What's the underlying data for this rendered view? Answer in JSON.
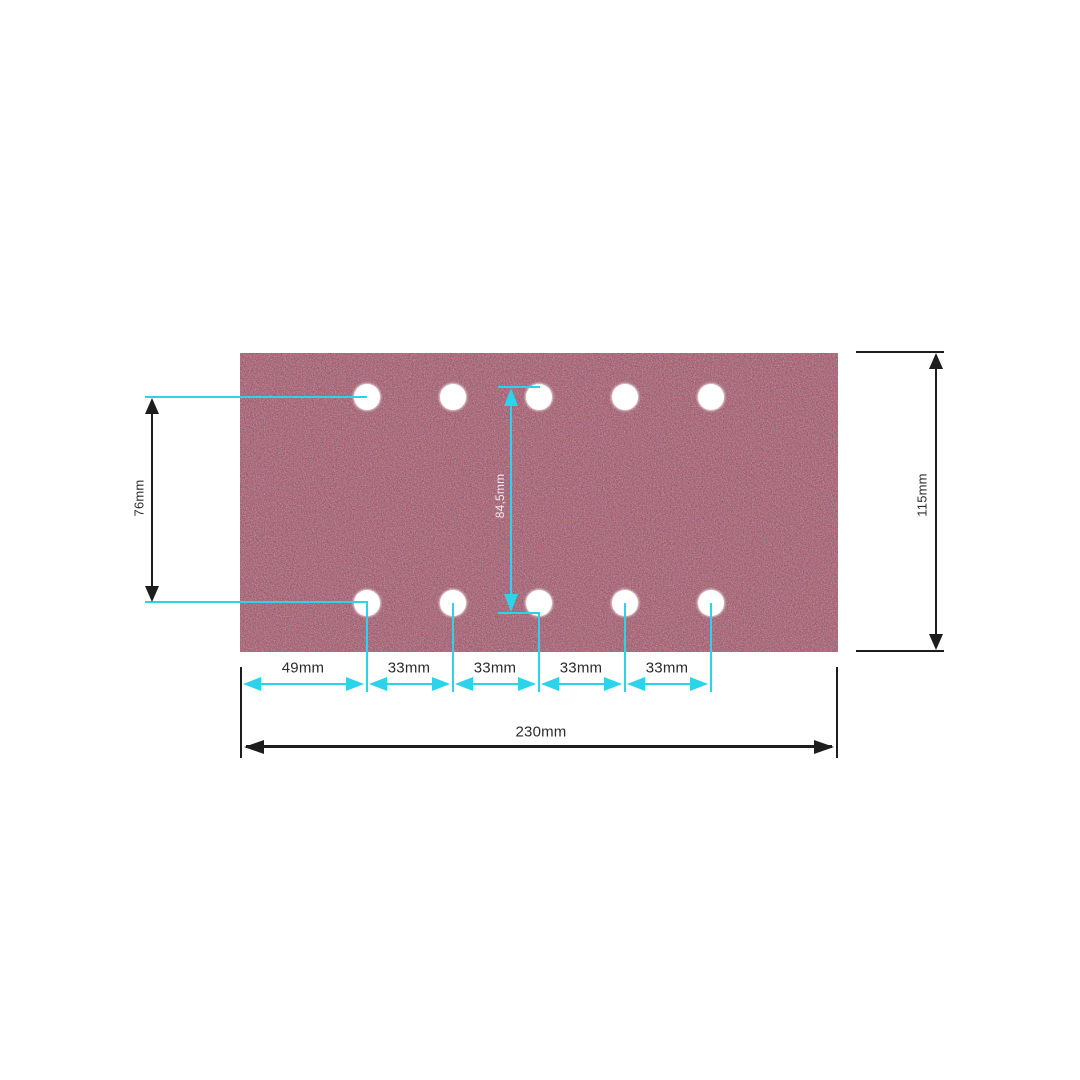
{
  "page": {
    "background_color": "#ffffff"
  },
  "diagram": {
    "type": "product-dimension-diagram",
    "subject": "rectangular sanding sheet with two rows of five punched holes",
    "colors": {
      "page_background": "#ffffff",
      "accent": "#2dd2eb",
      "line": "#1d1d1d",
      "sheet_base": "#571a29",
      "hole": "#ffffff",
      "label_text": "#2b2b2b",
      "label_text_light": "#efeaec"
    },
    "dimensions": {
      "left_vertical": {
        "label": "76mm"
      },
      "center_vertical": {
        "label": "84,5mm"
      },
      "right_vertical": {
        "label": "115mm"
      },
      "bottom_segments": [
        {
          "label": "49mm"
        },
        {
          "label": "33mm"
        },
        {
          "label": "33mm"
        },
        {
          "label": "33mm"
        },
        {
          "label": "33mm"
        }
      ],
      "bottom_total": {
        "label": "230mm"
      }
    }
  }
}
